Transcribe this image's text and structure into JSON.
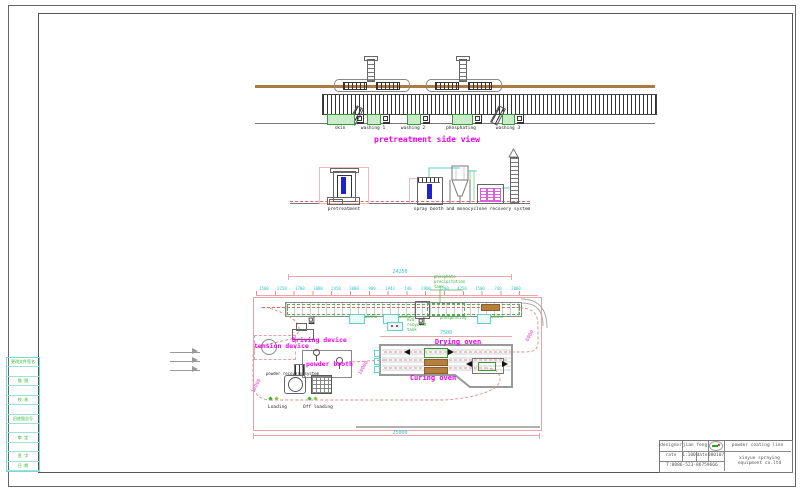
{
  "colors": {
    "magenta": "#ee00ee",
    "green": "#2eb82e",
    "cyan": "#35c4c4",
    "dim_pink": "#e8a8a8",
    "brown": "#ad7a42",
    "blue": "#2222cc"
  },
  "side_view": {
    "title": "pretreatment side view",
    "tanks": [
      {
        "label": "skin"
      },
      {
        "label": "washing 1"
      },
      {
        "label": "washing 2"
      },
      {
        "label": "phosphating"
      },
      {
        "label": "washing 3"
      }
    ]
  },
  "equipment_view": {
    "left_label": "pretreatment",
    "right_label": "spray booth and monocyclone recovery system"
  },
  "plan": {
    "labels": {
      "tension": "tension device",
      "driving": "Driving device",
      "booth": "powder booth",
      "drying": "Drying oven",
      "curing": "Curing oven",
      "loading": "Loading",
      "offloading": "Off loading",
      "recovery": "powder recovery system",
      "phosphating": "phosphating",
      "wash1": "wash1",
      "wash2": "wash2",
      "wash3": "wash3"
    },
    "notes": {
      "phosphate_tank_l1": "phosphate",
      "phosphate_tank_l2": "precipitation",
      "phosphate_tank_l3": "tank",
      "h2o_tank_l1": "H2O",
      "h2o_tank_l2": "recycled",
      "h2o_tank_l3": "tank"
    },
    "dims": {
      "total_top": "24250",
      "oven": "7500",
      "total_bottom": "25000",
      "diag_left": "10000",
      "diag_mid": "10000",
      "diag_right": "6000",
      "chain": [
        "1500",
        "2250",
        "1700",
        "3000",
        "2450",
        "3000",
        "900",
        "1943",
        "140",
        "2900",
        "1700",
        "4250",
        "1500",
        "740",
        "2000"
      ]
    }
  },
  "sheet": {
    "title_block": {
      "designer_label": "designer",
      "designer_value": "jian feng",
      "scale_label": "rate",
      "scale_value": "1:100",
      "date_label": "date",
      "date_value": "080107",
      "phone": "T:0086-523-86759666",
      "product": "powder coating line",
      "company": "xinyue spraying equipment co.ltd"
    },
    "rev_strip_rows": [
      "更改文件签名",
      "",
      "描 图",
      "",
      "校 核",
      "",
      "旧底图总号",
      "",
      "审 定",
      "",
      "签 字",
      "日 期"
    ]
  }
}
